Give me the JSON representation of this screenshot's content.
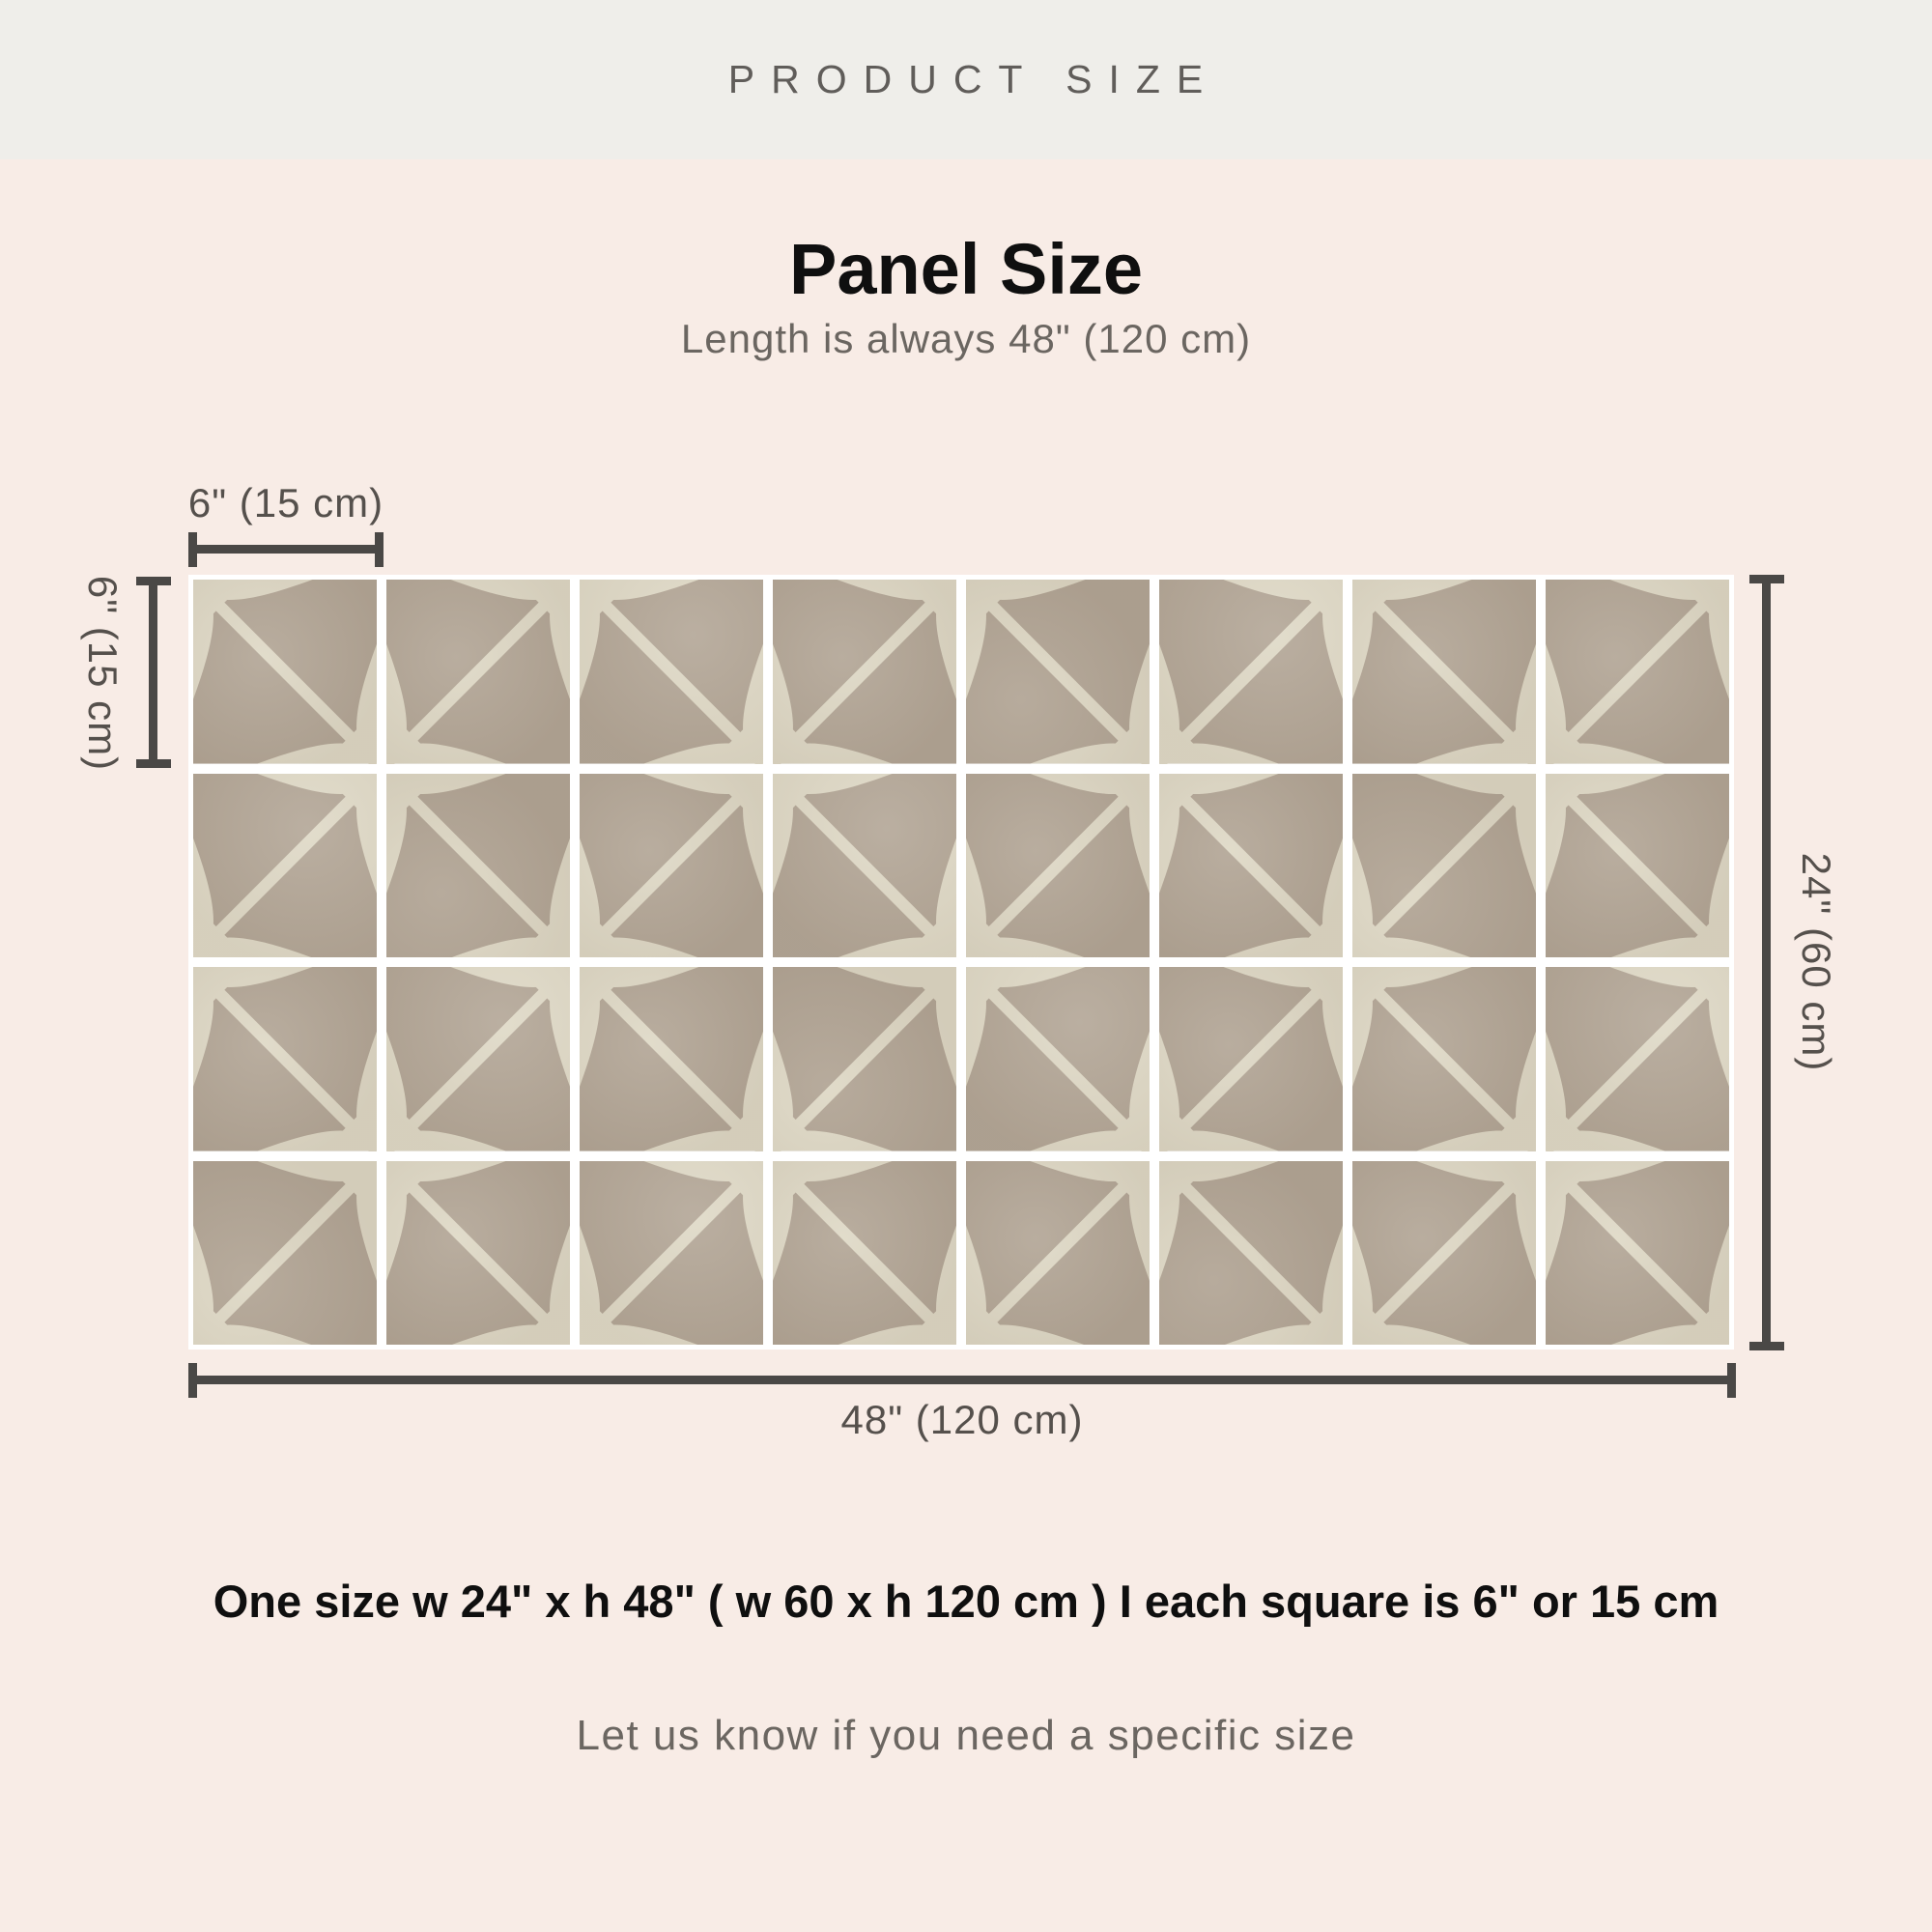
{
  "header": {
    "title": "PRODUCT SIZE"
  },
  "section": {
    "title": "Panel Size",
    "subtitle": "Length is always 48\" (120 cm)"
  },
  "diagram": {
    "grid": {
      "columns": 8,
      "rows": 4
    },
    "tile_width_label": "6\" (15 cm)",
    "tile_height_label": "6\" (15 cm)",
    "panel_height_label": "24\" (60 cm)",
    "panel_width_label": "48\" (120 cm)",
    "colors": {
      "tile_base": "#b1a494",
      "tile_accent": "#ded8c5",
      "grout": "#ffffff",
      "dimension_line": "#4a4846",
      "background": "#f8ece6",
      "topbar_background": "#efeeea"
    }
  },
  "footer": {
    "size_summary": "One size  w 24\" x h 48\" ( w 60 x h 120 cm )  I  each square is 6\" or 15 cm",
    "note": "Let us know if you need a specific size"
  }
}
